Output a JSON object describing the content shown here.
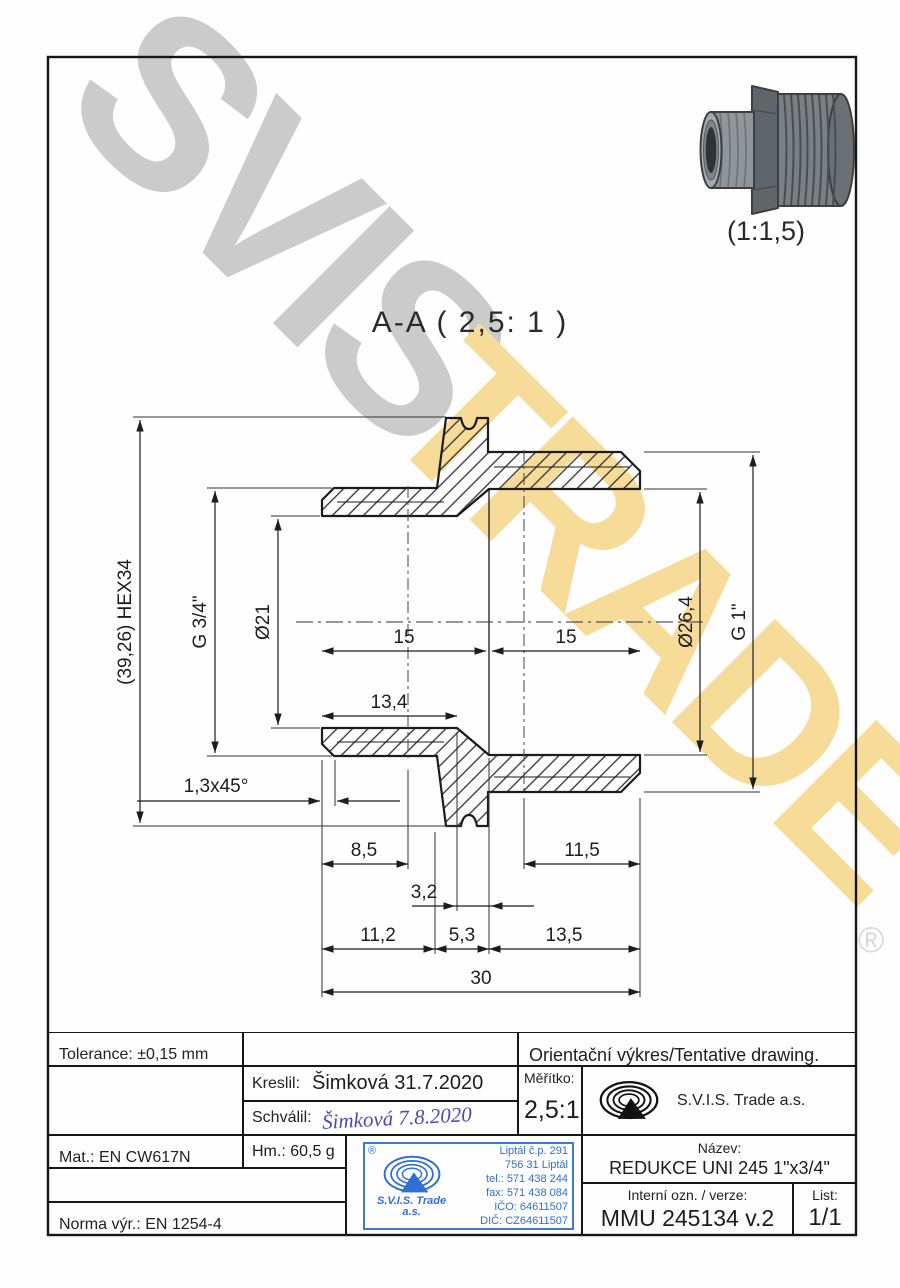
{
  "watermark": {
    "word1": "SVIS",
    "word2": "TRADE",
    "registered": "®",
    "gray": "#cbcbcb",
    "yellow": "#f7db99"
  },
  "view3d": {
    "scale_label": "(1:1,5)"
  },
  "section": {
    "label": "A-A ( 2,5: 1 )"
  },
  "dims": {
    "hex": "(39,26) HEX34",
    "g34": "G 3/4\"",
    "d21": "Ø21",
    "d264": "Ø26,4",
    "g1": "G 1\"",
    "len15a": "15",
    "len15b": "15",
    "d134": "13,4",
    "chamfer": "1,3x45°",
    "d85": "8,5",
    "d115": "11,5",
    "d32": "3,2",
    "d112": "11,2",
    "d53": "5,3",
    "d135": "13,5",
    "d30": "30"
  },
  "titleblock": {
    "tolerance": "Tolerance: ±0,15 mm",
    "orientacni": "Orientační výkres/Tentative drawing.",
    "kreslil_label": "Kreslil:",
    "kreslil_value": "Šimková 31.7.2020",
    "schvalil_label": "Schválil:",
    "schvalil_value": "Šimková  7.8.2020",
    "meritko_label": "Měřítko:",
    "meritko_value": "2,5:1",
    "company": "S.V.I.S. Trade a.s.",
    "mat": "Mat.: EN CW617N",
    "hm": "Hm.: 60,5 g",
    "norma": "Norma výr.: EN 1254-4",
    "nazev_label": "Název:",
    "nazev_value": "REDUKCE UNI 245 1\"x3/4\"",
    "interni_label": "Interní ozn. / verze:",
    "interni_value": "MMU 245134 v.2",
    "list_label": "List:",
    "list_value": "1/1",
    "stamp": {
      "registered": "®",
      "brand": "S.V.I.S. Trade",
      "brand2": "a.s.",
      "lines": [
        "Liptál č.p. 291",
        "756 31 Liptál",
        "tel.: 571 438 244",
        "fax: 571 438 084",
        "IČO: 64611507",
        "DIČ: CZ64611507"
      ]
    }
  }
}
